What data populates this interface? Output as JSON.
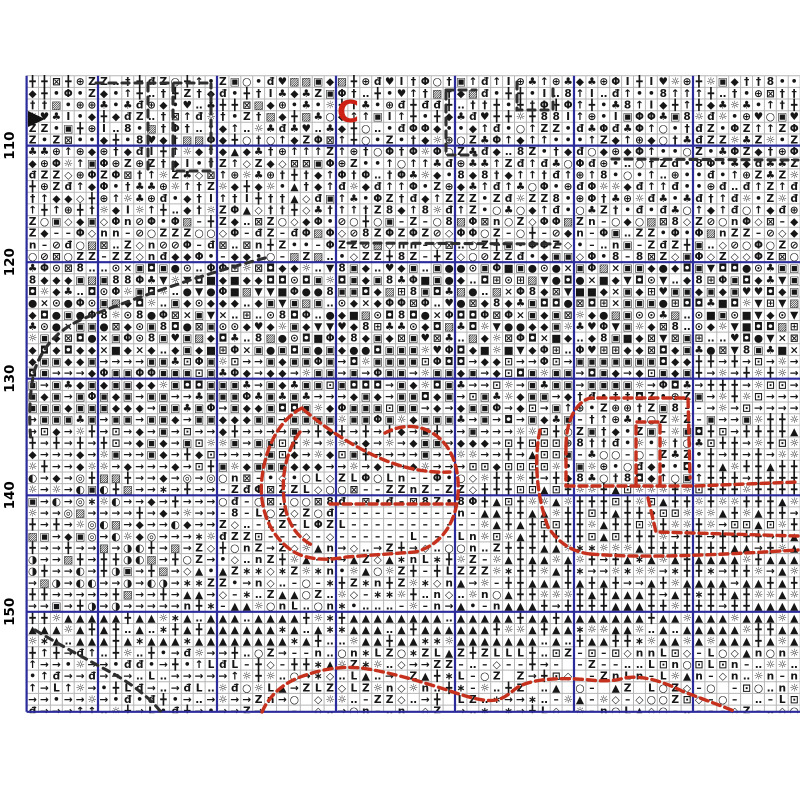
{
  "title": "cross-stitch-pattern-chart-page",
  "grid": {
    "x0": 26.6,
    "y0": 75.7,
    "cw": 11.9,
    "ch": 11.655,
    "cols": 66,
    "rows": 55,
    "clip_bottom": 711.8,
    "minor_color": "#b6b6b6",
    "major_color": "#2b2b9b",
    "symbol_color": "#161616",
    "background": "#ffffff",
    "major_cols": [
      6,
      16,
      26,
      36,
      46,
      56
    ],
    "major_rows": [
      6,
      16,
      26,
      36,
      46
    ]
  },
  "row_labels": [
    "110",
    "120",
    "130",
    "140",
    "150"
  ],
  "label_style": {
    "x": 14,
    "size": 13.5,
    "color": "#000000"
  },
  "symbol_zones": [
    {
      "r0": 0,
      "r1": 6,
      "c0": 0,
      "c1": 66,
      "s": "╋††◆đ••↑▨♥⊕▣ZZ○⊠ΦI♣◆╋†↑•đ☼‥8◆╋"
    },
    {
      "r0": 6,
      "r1": 12,
      "c0": 0,
      "c1": 66,
      "s": "⊕╋††Φ◆▣Z◇I▲đ•↑♣⊠☼⊕◆‥Z╋↑↑††"
    },
    {
      "r0": 4,
      "r1": 12,
      "c0": 28,
      "c1": 66,
      "s": "↑↑••đđZ†Z⊕♣☼◆8Φ‥○↑•đ"
    },
    {
      "r0": 12,
      "r1": 16,
      "c0": 0,
      "c1": 66,
      "s": "ZZZΦΦ⊠◇‥○––◆▣╋◇○⊘nđ•8▨ZΦ"
    },
    {
      "r0": 16,
      "r1": 24,
      "c0": 0,
      "c1": 66,
      "s": "◆◆◘▣▣●⊙♥8▨♣◆▣●◘☼▼■Φ⊠‥×⊞◆"
    },
    {
      "r0": 24,
      "r1": 30,
      "c0": 0,
      "c1": 66,
      "s": "▣▣◘◆→▣→♣Φ▣◆→▣⊡☼▣◆"
    },
    {
      "r0": 24,
      "r1": 30,
      "c0": 56,
      "c1": 66,
      "s": "→☼╋⊡☼→╋☼→▣"
    },
    {
      "r0": 30,
      "r1": 34,
      "c0": 0,
      "c1": 66,
      "s": "→▣→→◆╋☼⊡→▣→◆"
    },
    {
      "r0": 30,
      "r1": 34,
      "c0": 40,
      "c1": 66,
      "s": "╋☼⊡╋▲☼╋╋→☼"
    },
    {
      "r0": 34,
      "r1": 40,
      "c0": 0,
      "c1": 16,
      "s": "→╋◐◎▣◆→→☼∗→▨"
    },
    {
      "r0": 34,
      "r1": 40,
      "c0": 16,
      "c1": 38,
      "s": "–ZZ◇○nLΦ⊠‥○––◇đ⊡•8Z–"
    },
    {
      "r0": 34,
      "r1": 40,
      "c0": 38,
      "c1": 66,
      "s": "╋╋☼▲╋☼╋→⊡▲╋☼"
    },
    {
      "r0": 40,
      "r1": 46,
      "c0": 0,
      "c1": 13,
      "s": "→→╋→◐▣→◑→→▨"
    },
    {
      "r0": 40,
      "r1": 46,
      "c0": 13,
      "c1": 40,
      "s": "ZLn––◇▲☼‥•→╋∗○Zn"
    },
    {
      "r0": 40,
      "r1": 46,
      "c0": 40,
      "c1": 66,
      "s": "▲╋☼▲▲╋╋▲→☼∗╋"
    },
    {
      "r0": 46,
      "r1": 49,
      "c0": 0,
      "c1": 66,
      "s": "▲▲▲▲☼╋▲▲∗▲▲╋‥▲"
    },
    {
      "r0": 49,
      "r1": 55,
      "c0": 0,
      "c1": 18,
      "s": "→╋→→↑L•╋☼→đ‥→→"
    },
    {
      "r0": 49,
      "r1": 55,
      "c0": 18,
      "c1": 44,
      "s": "☼╋◇Zn–L▲‥○→╋ ∗Z–"
    },
    {
      "r0": 49,
      "r1": 55,
      "c0": 44,
      "c1": 66,
      "s": "–○◇nLZ‥▲☼– ○n⊡––"
    },
    {
      "r0": 27,
      "r1": 35,
      "c0": 45,
      "c1": 57,
      "s": "•đ↑–Z◆▣⊕○♣†☼◘8–•"
    },
    {
      "r0": 37,
      "r1": 40,
      "c0": 26,
      "c1": 38,
      "s": "–––L–n––––"
    }
  ],
  "overlays": {
    "red": {
      "color": "#c5311d",
      "width": 3.4,
      "dash": "8 5",
      "paths": [
        "M302,408 C282,418 266,443 262,478 C258,510 272,540 296,553 C312,561 332,560 346,557 L415,552 C440,546 456,524 458,494 C460,462 448,438 424,429 C410,424 396,427 385,433",
        "M300,432 C286,451 280,479 285,506 C288,524 298,538 312,545",
        "M304,410 C330,432 362,452 392,463 C412,470 432,473 450,472",
        "M330,504 L456,504",
        "M566,446 C566,424 574,403 590,398 L688,398 L690,478",
        "M566,446 L566,486",
        "M566,486 L694,486 L798,482",
        "M636,486 L636,422 L660,422 L660,486",
        "M540,430 C534,458 536,494 548,527 C560,545 574,552 590,554",
        "M590,554 C640,558 700,556 798,550",
        "M648,498 L656,532 L798,536",
        "M262,712 C270,694 285,682 303,676 C322,669 342,666 361,668 C385,671 420,681 450,691 C470,698 486,702 496,700 C506,698 512,691 518,687 C532,679 560,677 590,680 C608,682 618,680 624,678 C642,675 662,681 682,691 C702,699 720,705 736,712"
      ],
      "marker": {
        "text": "C",
        "x": 337,
        "y": 122,
        "size": 30,
        "color": "#cc2114"
      }
    },
    "black": {
      "color": "#2f2f2f",
      "width": 3.1,
      "dash": "7 6",
      "paths": [
        "M96,83 L213,83",
        "M148,84 L148,172",
        "M173,84 L173,171 L211,171 L211,84",
        "M517,82 L517,110 L553,110 L553,85",
        "M446,90 L476,90",
        "M446,92 L446,155 L476,155",
        "M612,159 L798,160",
        "M348,243 L560,244",
        "M265,258 C200,275 130,300 85,318 C60,328 42,346 34,372 C29,396 29,420 31,442",
        "M35,630 C60,645 88,660 112,673 C132,684 150,698 161,712"
      ],
      "arrow_marker": "M28,111 L45,119 L28,127 Z"
    }
  }
}
